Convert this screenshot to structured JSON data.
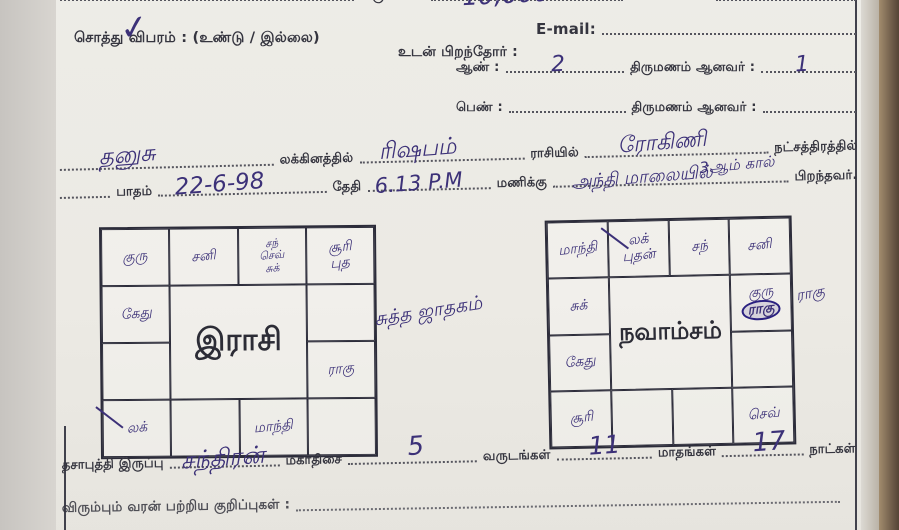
{
  "colors": {
    "ink": "#3c3178",
    "print": "#34343e",
    "paper": "#edece7",
    "grid_line": "#2c2c3a",
    "scan_edge": "#6a5847"
  },
  "header": {
    "income_label": "வருமானம்",
    "income_value": "10,000",
    "phone_label": "போன் எண் :",
    "property_label": "சொத்து விபரம் : (உண்டு / இல்லை)",
    "tick": "✓",
    "email_label": "E-mail:",
    "siblings_label": "உடன் பிறந்தோர் :",
    "male_label": "ஆண் :",
    "male_count": "2",
    "male_married_label": "திருமணம் ஆனவர் :",
    "male_married_count": "1",
    "female_label": "பெண் :",
    "female_married_label": "திருமணம் ஆனவர் :"
  },
  "birth_line": {
    "lagna_value": "தனுசு",
    "lagna_label": "லக்கினத்தில்",
    "rasi_value": "ரிஷபம்",
    "rasi_label": "ராசியில்",
    "star_value": "ரோகிணி",
    "star_label": "நட்சத்திரத்தில்",
    "padam_label": "பாதம்",
    "date_value": "22-6-98",
    "date_label": "தேதி",
    "time_value": "6.13 P.M",
    "time_label": "மணிக்கு",
    "padam_note": "3ஆம் கால்",
    "evening_value": "அந்தி மாலையில்",
    "born_label": "பிறந்தவர்."
  },
  "rasi_chart": {
    "title": "இராசி",
    "cells": [
      {
        "planets": [
          {
            "t": "குரு"
          }
        ]
      },
      {
        "planets": [
          {
            "t": "சனி"
          }
        ]
      },
      {
        "planets": [
          {
            "t": "சந்"
          },
          {
            "t": "செவ்"
          },
          {
            "t": "சுக்"
          }
        ]
      },
      {
        "planets": [
          {
            "t": "சூரி"
          },
          {
            "t": "புத"
          }
        ]
      },
      {
        "planets": [
          {
            "t": "கேது"
          }
        ]
      },
      {
        "planets": []
      },
      {
        "planets": []
      },
      {
        "planets": [
          {
            "t": "ராகு"
          }
        ]
      },
      {
        "planets": [
          {
            "t": "லக்"
          }
        ],
        "slash": true
      },
      {
        "planets": []
      },
      {
        "planets": [
          {
            "t": "மாந்தி"
          }
        ]
      },
      {
        "planets": []
      }
    ]
  },
  "center_note": "சுத்த ஜாதகம்",
  "navamsam_chart": {
    "title": "நவாம்சம்",
    "outside_note": "ராகு",
    "cells": [
      {
        "planets": [
          {
            "t": "மாந்தி"
          }
        ]
      },
      {
        "planets": [
          {
            "t": "லக்"
          },
          {
            "t": "புதன்"
          }
        ],
        "slash": true
      },
      {
        "planets": [
          {
            "t": "சந்"
          }
        ]
      },
      {
        "planets": [
          {
            "t": "சனி"
          }
        ]
      },
      {
        "planets": [
          {
            "t": "சுக்"
          }
        ]
      },
      {
        "planets": [
          {
            "t": "குரு"
          },
          {
            "t": "ராகு",
            "circled": true
          }
        ]
      },
      {
        "planets": [
          {
            "t": "கேது"
          }
        ]
      },
      {
        "planets": []
      },
      {
        "planets": [
          {
            "t": "சூரி"
          }
        ]
      },
      {
        "planets": []
      },
      {
        "planets": []
      },
      {
        "planets": [
          {
            "t": "செவ்"
          }
        ]
      }
    ]
  },
  "dasa_line": {
    "label": "தசாபுத்தி இருப்பு",
    "dasa_value": "சந்திரன்",
    "mahadasa_label": "மகாதிசை",
    "years_value": "5",
    "years_label": "வருடங்கள்",
    "months_value": "11",
    "months_label": "மாதங்கள்",
    "days_value": "17",
    "days_label": "நாட்கள்"
  },
  "notes_line": {
    "label": "விரும்பும் வரன் பற்றிய குறிப்புகள் :"
  }
}
